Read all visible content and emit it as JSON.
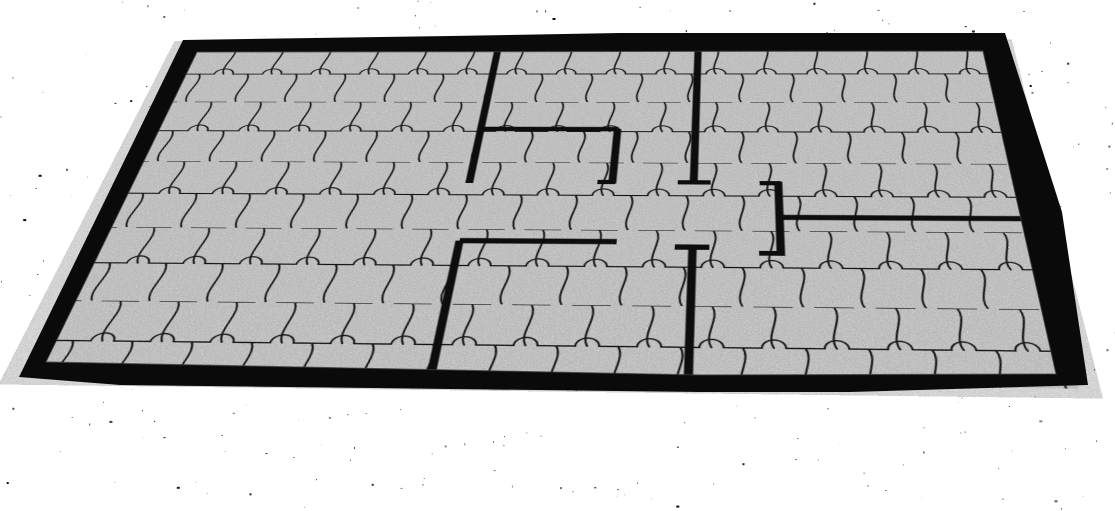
{
  "scene": {
    "canvas": {
      "width": 1115,
      "height": 511,
      "background_color": "#ffffff"
    },
    "speckles": {
      "color": "#000000",
      "count": 300,
      "faint_count": 80,
      "seed": 9
    },
    "floor": {
      "plan_width": 1000,
      "plan_height": 580,
      "corners": {
        "top_left": [
          197,
          52
        ],
        "top_right": [
          983,
          51
        ],
        "bottom_left": [
          46,
          362
        ],
        "bottom_right": [
          1056,
          374
        ]
      },
      "base_color": "#e8e8e8",
      "grain_opacity": 0.22,
      "paver": {
        "width": 62,
        "row_height": 62,
        "notch_radius": 12,
        "line_color": "#1b1b1b",
        "line_width": 2.1
      }
    },
    "perimeter": {
      "fill_color": "#0a0a0a",
      "bevel_color": "#3a3a3a",
      "outer_points": [
        [
          183,
          40
        ],
        [
          450,
          36
        ],
        [
          620,
          33
        ],
        [
          1005,
          33
        ],
        [
          1062,
          212
        ],
        [
          1088,
          385
        ],
        [
          850,
          392
        ],
        [
          700,
          392
        ],
        [
          120,
          385
        ],
        [
          19,
          377
        ]
      ],
      "inner_points": [
        [
          197,
          52
        ],
        [
          983,
          51
        ],
        [
          1056,
          374
        ],
        [
          700,
          375
        ],
        [
          46,
          362
        ]
      ]
    },
    "interior_walls": {
      "color": "#0d0d0d",
      "thickness": 9,
      "segments": [
        {
          "name": "left-divider-upper",
          "from": [
            390,
            0
          ],
          "to": [
            390,
            278
          ]
        },
        {
          "name": "nook-top",
          "from": [
            386,
            171
          ],
          "to": [
            553,
            171
          ]
        },
        {
          "name": "nook-right",
          "from": [
            553,
            171
          ],
          "to": [
            553,
            278
          ]
        },
        {
          "name": "center-divider-upper",
          "from": [
            645,
            0
          ],
          "to": [
            645,
            278
          ]
        },
        {
          "name": "right-stub",
          "from": [
            740,
            273
          ],
          "to": [
            740,
            404
          ]
        },
        {
          "name": "right-room-divider",
          "from": [
            744,
            338
          ],
          "to": [
            1000,
            338
          ]
        },
        {
          "name": "bottom-room-top",
          "from": [
            393,
            382
          ],
          "to": [
            564,
            382
          ]
        },
        {
          "name": "left-divider-lower",
          "from": [
            393,
            382
          ],
          "to": [
            393,
            580
          ]
        },
        {
          "name": "center-divider-lower",
          "from": [
            646,
            390
          ],
          "to": [
            646,
            580
          ]
        }
      ],
      "end_caps": [
        {
          "name": "center-upper-cap",
          "x": 627,
          "y": 271,
          "w": 37,
          "h": 8
        },
        {
          "name": "nook-right-foot",
          "x": 536,
          "y": 271,
          "w": 20,
          "h": 8
        },
        {
          "name": "right-stub-cap-top",
          "x": 719,
          "y": 272,
          "w": 24,
          "h": 8
        },
        {
          "name": "right-stub-cap-bottom",
          "x": 717,
          "y": 396,
          "w": 26,
          "h": 8
        },
        {
          "name": "center-lower-cap",
          "x": 627,
          "y": 386,
          "w": 37,
          "h": 9
        }
      ]
    }
  }
}
